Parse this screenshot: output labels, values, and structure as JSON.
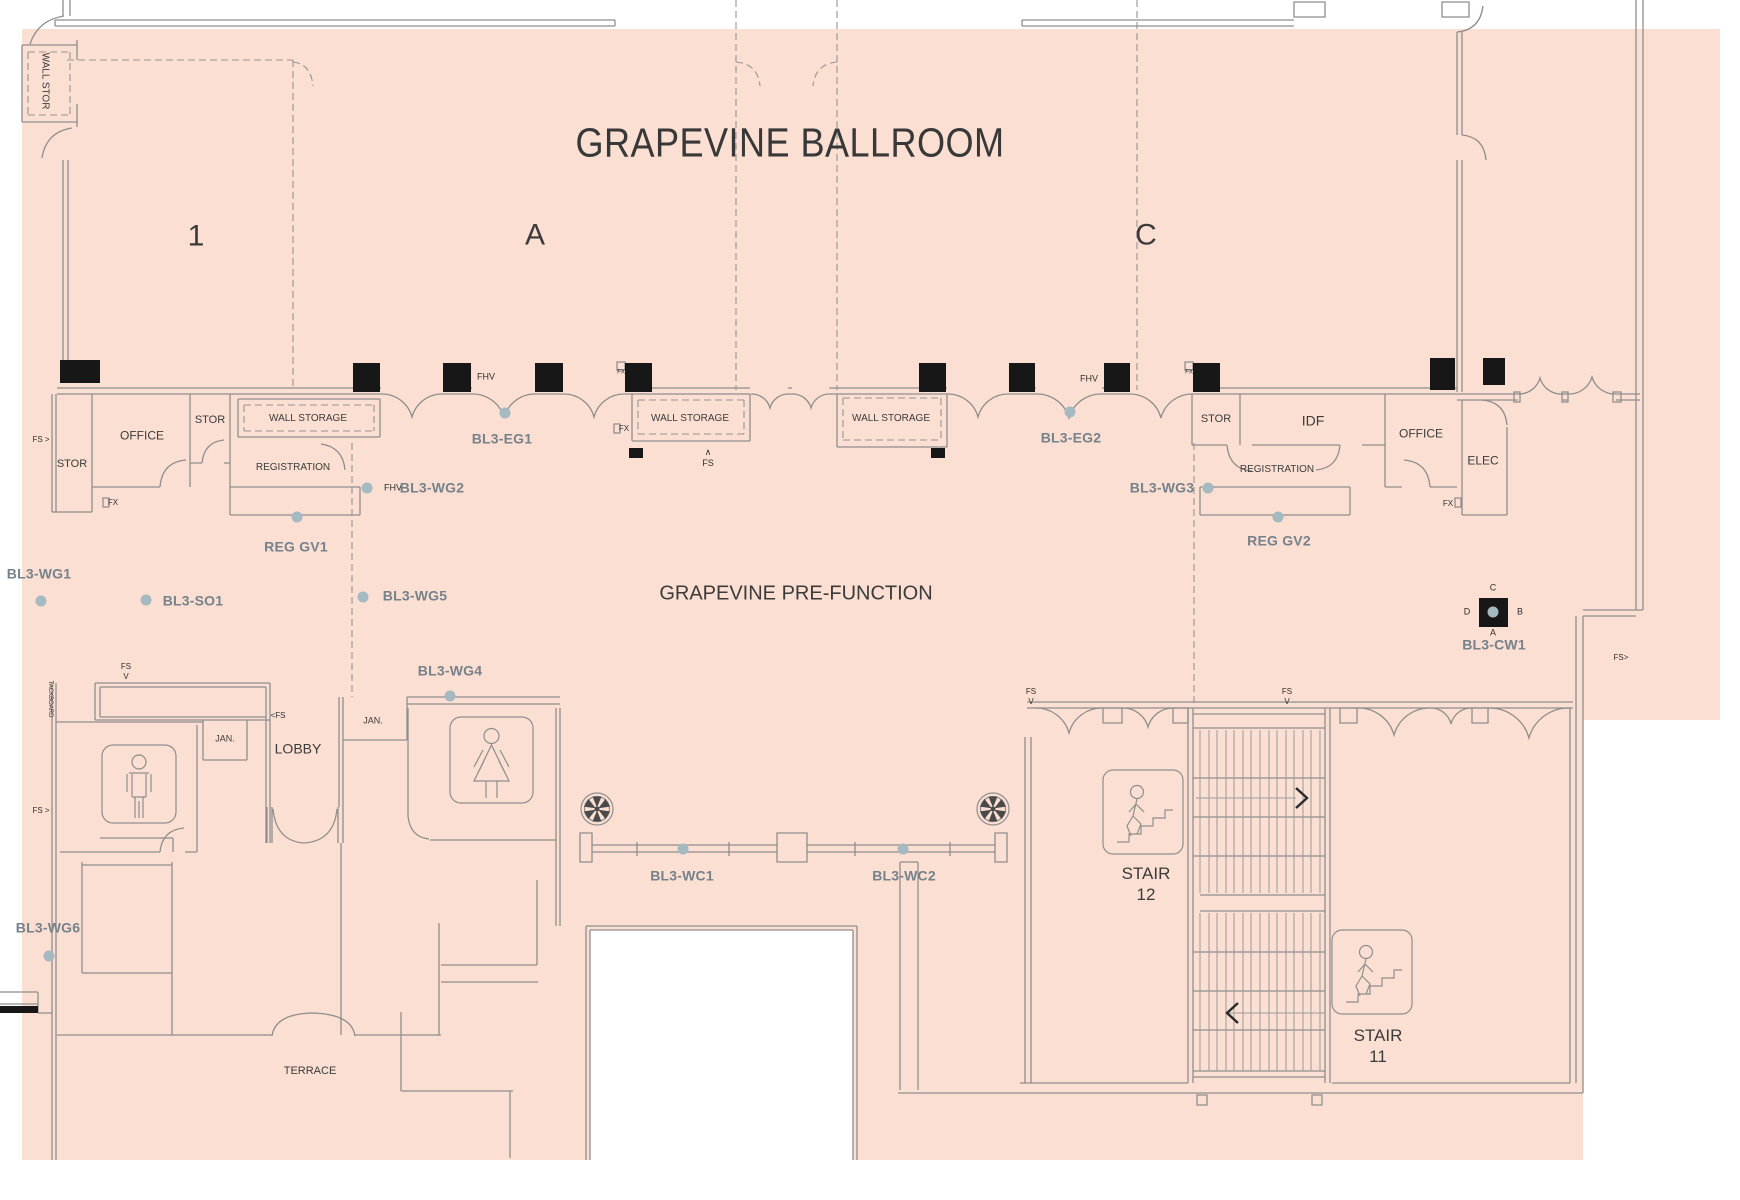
{
  "plan": {
    "drawing_title": "GRAPEVINE BALLROOM",
    "prefunction_title": "GRAPEVINE PRE-FUNCTION",
    "ballroom_sections": [
      "1",
      "A",
      "C"
    ],
    "stairs": [
      "STAIR 12",
      "STAIR 11"
    ]
  },
  "colors": {
    "floor_fill": "#fbdfd2",
    "wall_line": "#8e8e8e",
    "column_fill": "#171717",
    "equip_text": "#76828b",
    "room_text": "#3b3b3b",
    "dot_fill": "#a5b9c1",
    "background": "#ffffff"
  },
  "icons": [
    "mens-restroom-icon",
    "womens-restroom-icon",
    "stair-up-icon-12",
    "stair-up-icon-11",
    "ceiling-fan-icon-left",
    "ceiling-fan-icon-right",
    "camera-marker-bl3-cw1"
  ],
  "labels": [
    {
      "id": "page-title",
      "t": "GRAPEVINE BALLROOM",
      "x": 790,
      "y": 143,
      "fs": 41,
      "cls": "title"
    },
    {
      "id": "ballroom-section-1",
      "t": "1",
      "x": 196,
      "y": 236,
      "fs": 30,
      "cls": "room"
    },
    {
      "id": "ballroom-section-a",
      "t": "A",
      "x": 535,
      "y": 235,
      "fs": 30,
      "cls": "room"
    },
    {
      "id": "ballroom-section-c",
      "t": "C",
      "x": 1146,
      "y": 235,
      "fs": 30,
      "cls": "room"
    },
    {
      "id": "prefunction-title",
      "t": "GRAPEVINE PRE-FUNCTION",
      "x": 796,
      "y": 594,
      "fs": 20,
      "cls": "room"
    },
    {
      "id": "wall-stor-label",
      "t": "WALL STOR",
      "x": 44,
      "y": 81,
      "fs": 10,
      "cls": "room",
      "rot": 90
    },
    {
      "id": "stor-left-1",
      "t": "STOR",
      "x": 72,
      "y": 465,
      "fs": 11,
      "cls": "room"
    },
    {
      "id": "office-left",
      "t": "OFFICE",
      "x": 142,
      "y": 436,
      "fs": 12,
      "cls": "room"
    },
    {
      "id": "stor-left-2",
      "t": "STOR",
      "x": 210,
      "y": 421,
      "fs": 11,
      "cls": "room"
    },
    {
      "id": "wall-storage-left",
      "t": "WALL STORAGE",
      "x": 308,
      "y": 419,
      "fs": 10,
      "cls": "room"
    },
    {
      "id": "registration-left",
      "t": "REGISTRATION",
      "x": 293,
      "y": 468,
      "fs": 10,
      "cls": "room"
    },
    {
      "id": "reg-gv1",
      "t": "REG GV1",
      "x": 296,
      "y": 547,
      "fs": 14,
      "cls": "equip"
    },
    {
      "id": "fhv-wg2",
      "t": "FHV",
      "x": 393,
      "y": 488,
      "fs": 9,
      "cls": "tiny"
    },
    {
      "id": "bl3-wg2",
      "t": "BL3-WG2",
      "x": 432,
      "y": 488,
      "fs": 14,
      "cls": "equip"
    },
    {
      "id": "bl3-eg1",
      "t": "BL3-EG1",
      "x": 502,
      "y": 439,
      "fs": 14,
      "cls": "equip"
    },
    {
      "id": "fhv-1",
      "t": "FHV",
      "x": 486,
      "y": 377,
      "fs": 9,
      "cls": "tiny"
    },
    {
      "id": "wall-storage-mid1",
      "t": "WALL STORAGE",
      "x": 690,
      "y": 419,
      "fs": 10,
      "cls": "room"
    },
    {
      "id": "fs-up-1",
      "t": "∧\nFS",
      "x": 708,
      "y": 458,
      "fs": 9,
      "cls": "tiny"
    },
    {
      "id": "wall-storage-mid2",
      "t": "WALL STORAGE",
      "x": 891,
      "y": 419,
      "fs": 10,
      "cls": "room"
    },
    {
      "id": "bl3-eg2",
      "t": "BL3-EG2",
      "x": 1071,
      "y": 438,
      "fs": 14,
      "cls": "equip"
    },
    {
      "id": "fhv-2",
      "t": "FHV",
      "x": 1089,
      "y": 379,
      "fs": 9,
      "cls": "tiny"
    },
    {
      "id": "stor-right",
      "t": "STOR",
      "x": 1216,
      "y": 420,
      "fs": 11,
      "cls": "room"
    },
    {
      "id": "idf",
      "t": "IDF",
      "x": 1313,
      "y": 421,
      "fs": 14,
      "cls": "room"
    },
    {
      "id": "office-right",
      "t": "OFFICE",
      "x": 1421,
      "y": 434,
      "fs": 12,
      "cls": "room"
    },
    {
      "id": "elec",
      "t": "ELEC",
      "x": 1483,
      "y": 461,
      "fs": 12,
      "cls": "room"
    },
    {
      "id": "registration-right",
      "t": "REGISTRATION",
      "x": 1277,
      "y": 470,
      "fs": 10,
      "cls": "room"
    },
    {
      "id": "bl3-wg3",
      "t": "BL3-WG3",
      "x": 1162,
      "y": 488,
      "fs": 14,
      "cls": "equip"
    },
    {
      "id": "reg-gv2",
      "t": "REG GV2",
      "x": 1279,
      "y": 541,
      "fs": 14,
      "cls": "equip"
    },
    {
      "id": "fx-right",
      "t": "FX",
      "x": 1448,
      "y": 504,
      "fs": 8,
      "cls": "tiny"
    },
    {
      "id": "fx-left",
      "t": "FX",
      "x": 113,
      "y": 503,
      "fs": 8,
      "cls": "tiny"
    },
    {
      "id": "fx-mid",
      "t": "FX",
      "x": 624,
      "y": 429,
      "fs": 8,
      "cls": "tiny"
    },
    {
      "id": "fx-tiny-mid",
      "t": "FX",
      "x": 621,
      "y": 373,
      "fs": 6,
      "cls": "tiny"
    },
    {
      "id": "fx-tiny-right",
      "t": "FX",
      "x": 1189,
      "y": 373,
      "fs": 6,
      "cls": "tiny"
    },
    {
      "id": "fs-arrow-left-1",
      "t": "FS >",
      "x": 41,
      "y": 440,
      "fs": 8,
      "cls": "tiny"
    },
    {
      "id": "bl3-wg1",
      "t": "BL3-WG1",
      "x": 39,
      "y": 574,
      "fs": 14,
      "cls": "equip"
    },
    {
      "id": "bl3-so1",
      "t": "BL3-SO1",
      "x": 193,
      "y": 601,
      "fs": 14,
      "cls": "equip"
    },
    {
      "id": "bl3-wg5",
      "t": "BL3-WG5",
      "x": 415,
      "y": 596,
      "fs": 14,
      "cls": "equip"
    },
    {
      "id": "bl3-cw1",
      "t": "BL3-CW1",
      "x": 1494,
      "y": 645,
      "fs": 14,
      "cls": "equip"
    },
    {
      "id": "cw1-c",
      "t": "C",
      "x": 1493,
      "y": 588,
      "fs": 9,
      "cls": "tiny"
    },
    {
      "id": "cw1-d",
      "t": "D",
      "x": 1467,
      "y": 612,
      "fs": 9,
      "cls": "tiny"
    },
    {
      "id": "cw1-b",
      "t": "B",
      "x": 1520,
      "y": 612,
      "fs": 9,
      "cls": "tiny"
    },
    {
      "id": "cw1-a",
      "t": "A",
      "x": 1493,
      "y": 633,
      "fs": 9,
      "cls": "tiny"
    },
    {
      "id": "fs-arrow-right",
      "t": "FS>",
      "x": 1621,
      "y": 658,
      "fs": 8,
      "cls": "tiny"
    },
    {
      "id": "bl3-wg4",
      "t": "BL3-WG4",
      "x": 450,
      "y": 671,
      "fs": 14,
      "cls": "equip"
    },
    {
      "id": "fs-v-1",
      "t": "FS\nV",
      "x": 126,
      "y": 672,
      "fs": 8,
      "cls": "tiny"
    },
    {
      "id": "board-vert",
      "t": "TACKBOARD",
      "x": 49,
      "y": 699,
      "fs": 6,
      "cls": "tiny",
      "rot": 90
    },
    {
      "id": "jan-left",
      "t": "JAN.",
      "x": 225,
      "y": 739,
      "fs": 9,
      "cls": "room"
    },
    {
      "id": "jan-right",
      "t": "JAN.",
      "x": 373,
      "y": 721,
      "fs": 9,
      "cls": "room"
    },
    {
      "id": "lobby",
      "t": "LOBBY",
      "x": 298,
      "y": 749,
      "fs": 14,
      "cls": "room"
    },
    {
      "id": "fs-arrow-2",
      "t": "<FS",
      "x": 278,
      "y": 716,
      "fs": 8,
      "cls": "tiny"
    },
    {
      "id": "fs-arrow-left-2",
      "t": "FS >",
      "x": 41,
      "y": 811,
      "fs": 8,
      "cls": "tiny"
    },
    {
      "id": "bl3-wc1",
      "t": "BL3-WC1",
      "x": 682,
      "y": 876,
      "fs": 14,
      "cls": "equip"
    },
    {
      "id": "bl3-wc2",
      "t": "BL3-WC2",
      "x": 904,
      "y": 876,
      "fs": 14,
      "cls": "equip"
    },
    {
      "id": "bl3-wg6",
      "t": "BL3-WG6",
      "x": 48,
      "y": 928,
      "fs": 14,
      "cls": "equip"
    },
    {
      "id": "terrace",
      "t": "TERRACE",
      "x": 310,
      "y": 1072,
      "fs": 11,
      "cls": "room"
    },
    {
      "id": "fs-v-2",
      "t": "FS\nV",
      "x": 1031,
      "y": 697,
      "fs": 8,
      "cls": "tiny"
    },
    {
      "id": "fs-v-3",
      "t": "FS\nV",
      "x": 1287,
      "y": 697,
      "fs": 8,
      "cls": "tiny"
    },
    {
      "id": "stair-12",
      "t": "STAIR\n12",
      "x": 1146,
      "y": 884,
      "fs": 17,
      "cls": "room"
    },
    {
      "id": "stair-11",
      "t": "STAIR\n11",
      "x": 1378,
      "y": 1046,
      "fs": 17,
      "cls": "room"
    }
  ],
  "dots": [
    {
      "id": "reg-gv1-dot",
      "x": 297,
      "y": 517
    },
    {
      "id": "bl3-wg2-dot",
      "x": 367,
      "y": 488
    },
    {
      "id": "bl3-eg1-dot",
      "x": 505,
      "y": 413
    },
    {
      "id": "bl3-eg2-dot",
      "x": 1070,
      "y": 412
    },
    {
      "id": "bl3-wg3-dot",
      "x": 1208,
      "y": 488
    },
    {
      "id": "reg-gv2-dot",
      "x": 1278,
      "y": 517
    },
    {
      "id": "bl3-wg1-dot",
      "x": 41,
      "y": 601
    },
    {
      "id": "bl3-so1-dot",
      "x": 146,
      "y": 600
    },
    {
      "id": "bl3-wg5-dot",
      "x": 363,
      "y": 597
    },
    {
      "id": "bl3-wg4-dot",
      "x": 450,
      "y": 696
    },
    {
      "id": "bl3-wg6-dot",
      "x": 49,
      "y": 956
    },
    {
      "id": "bl3-wc1-dot",
      "x": 683,
      "y": 849
    },
    {
      "id": "bl3-wc2-dot",
      "x": 903,
      "y": 849
    },
    {
      "id": "bl3-cw1-dot",
      "x": 1493,
      "y": 612
    }
  ]
}
